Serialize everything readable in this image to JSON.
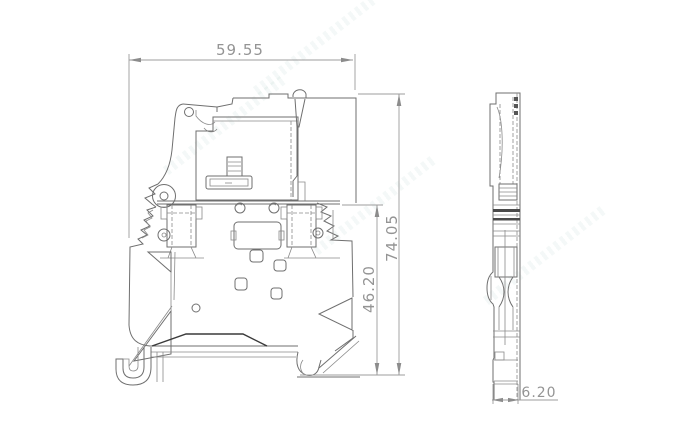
{
  "drawing": {
    "dimensions": {
      "width": "59.55",
      "overall_height": "74.05",
      "body_height": "46.20",
      "thickness": "6.20"
    },
    "colors": {
      "background": "#ffffff",
      "outline": "#6f6f6f",
      "dark_detail": "#3a3a3a",
      "dimension": "#9c9c9c"
    }
  }
}
